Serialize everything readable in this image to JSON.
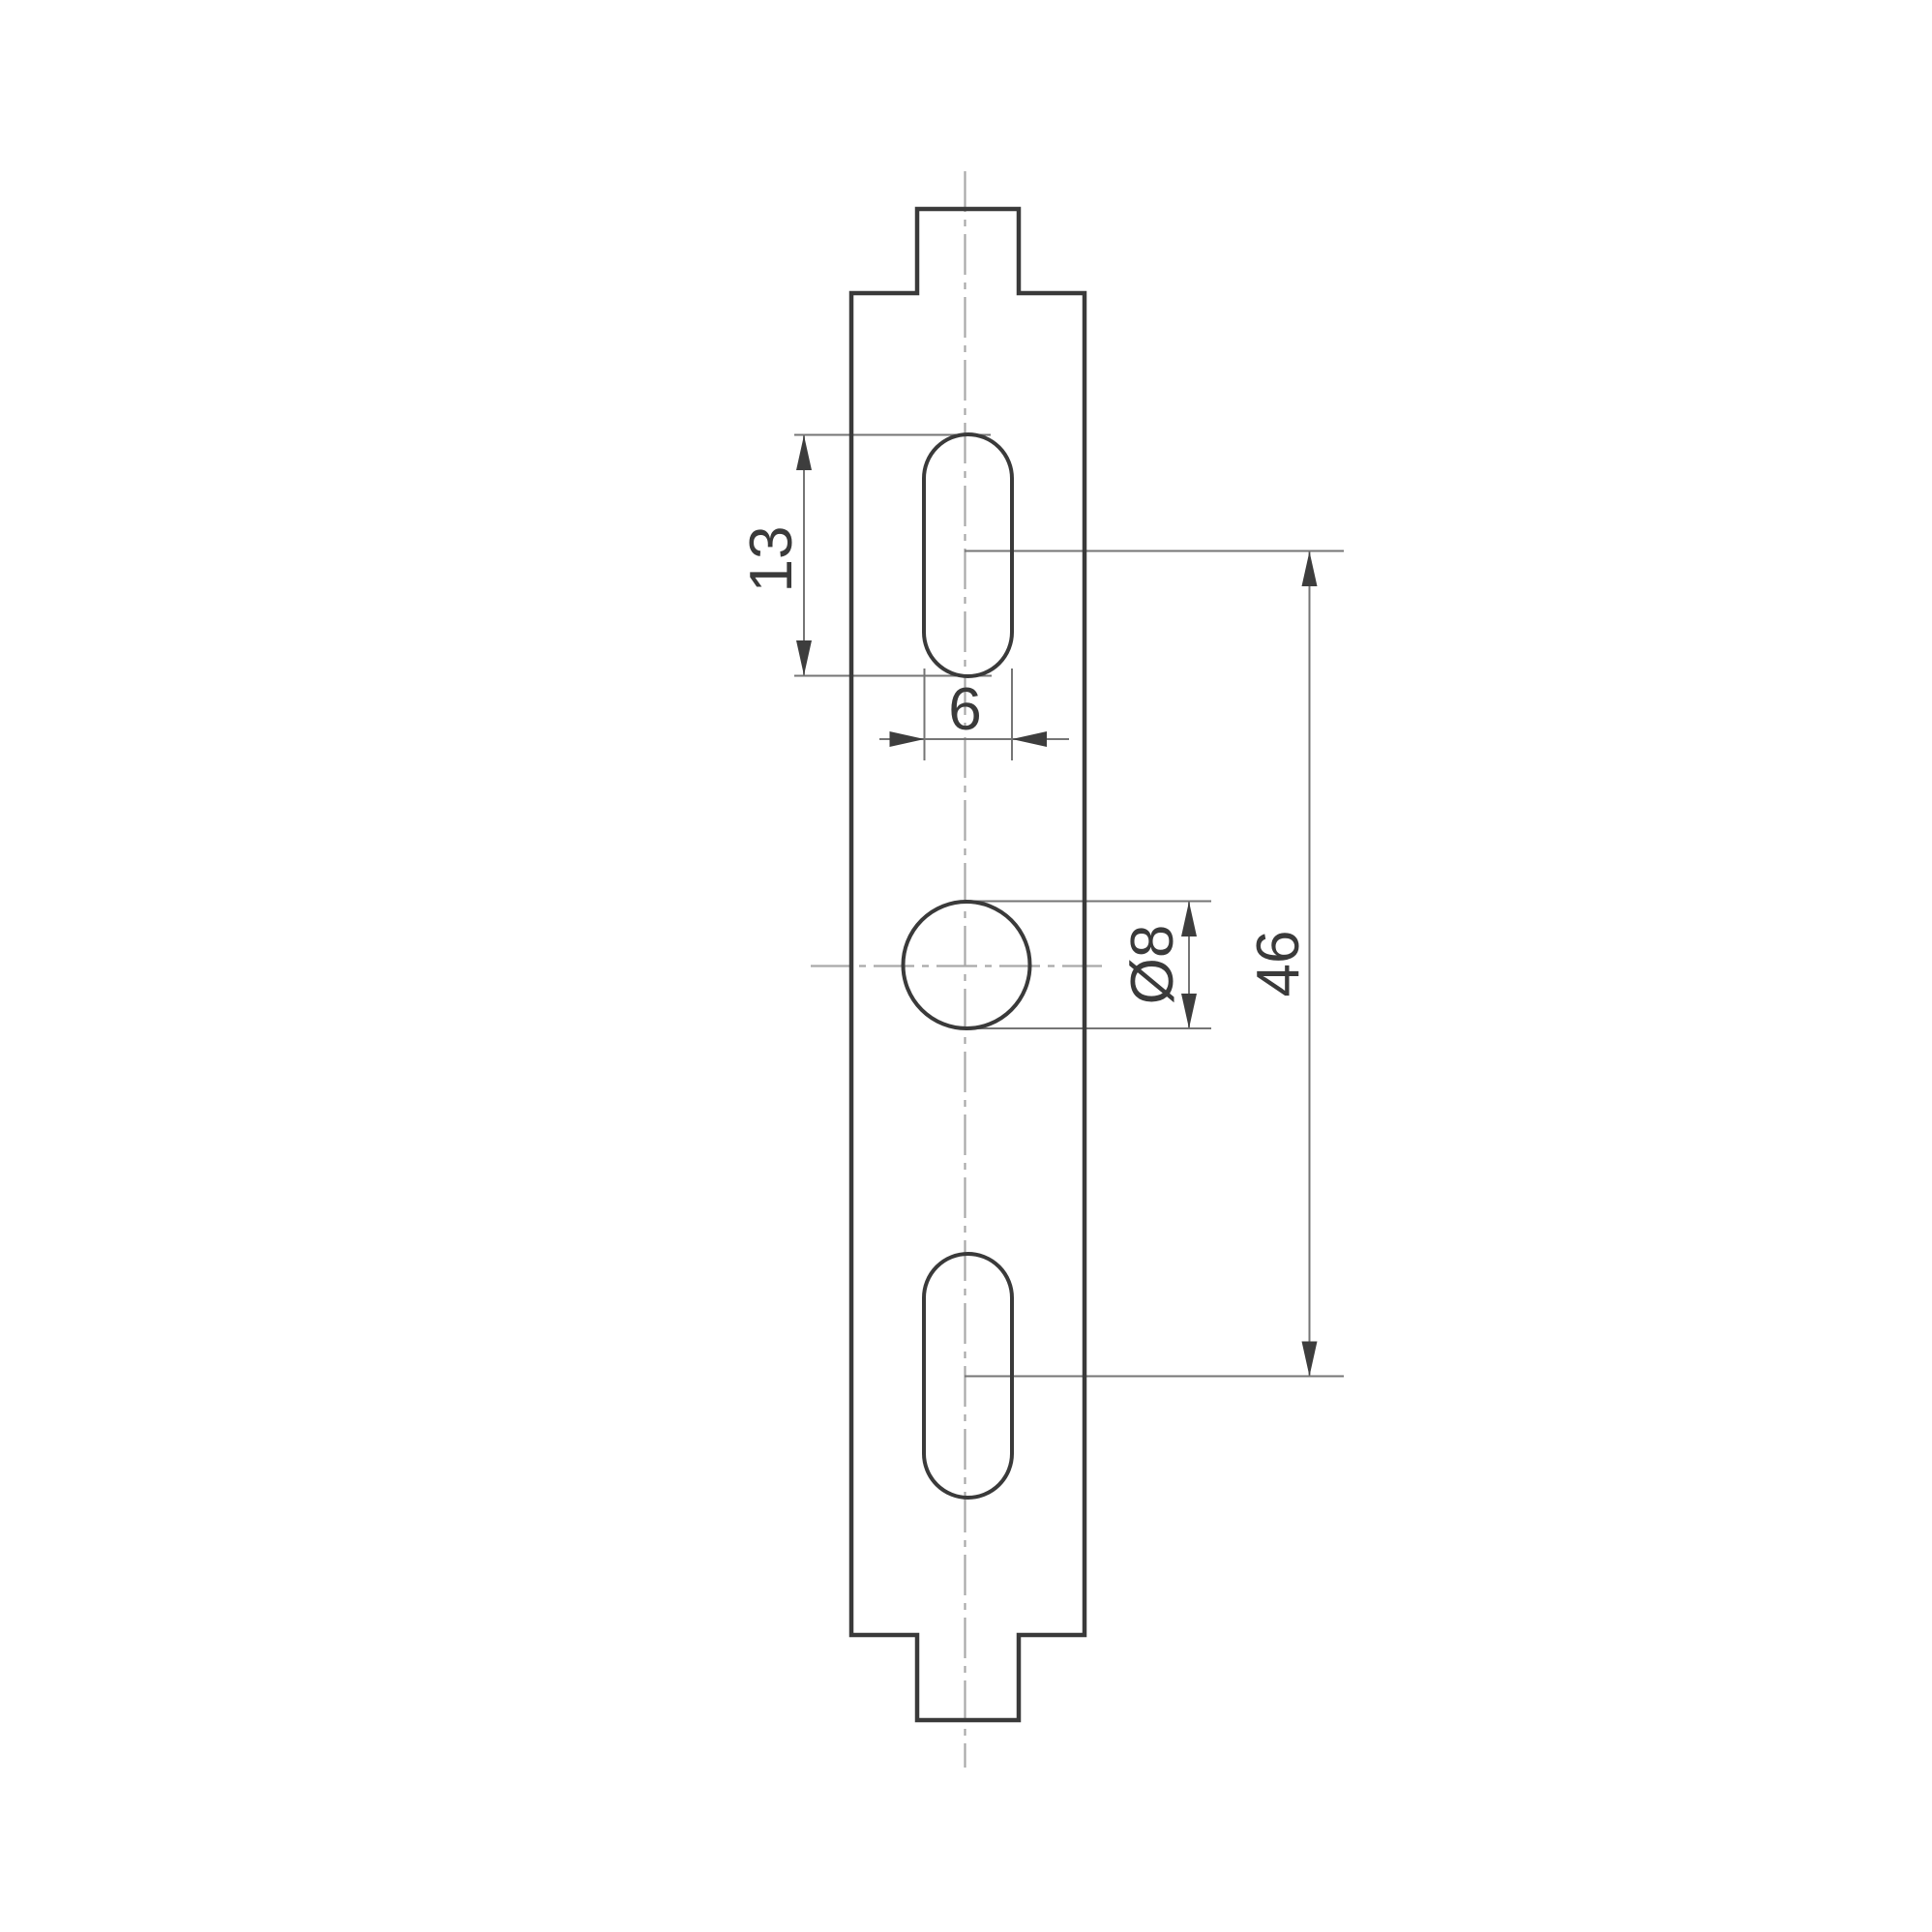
{
  "drawing": {
    "kind": "engineering-dimension-drawing",
    "part": "vertical mounting plate profile with two slots and one round hole",
    "dimensions": {
      "slot_length": "13",
      "slot_width": "6",
      "hole_diameter": "Ø8",
      "hole_spacing": "46"
    },
    "colors": {
      "background": "#ffffff",
      "outline": "#3a3a3a",
      "dimension_line": "#757575",
      "centerline": "#a9a9a9",
      "arrow": "#3d3d3d",
      "text": "#3a3a3a"
    }
  }
}
